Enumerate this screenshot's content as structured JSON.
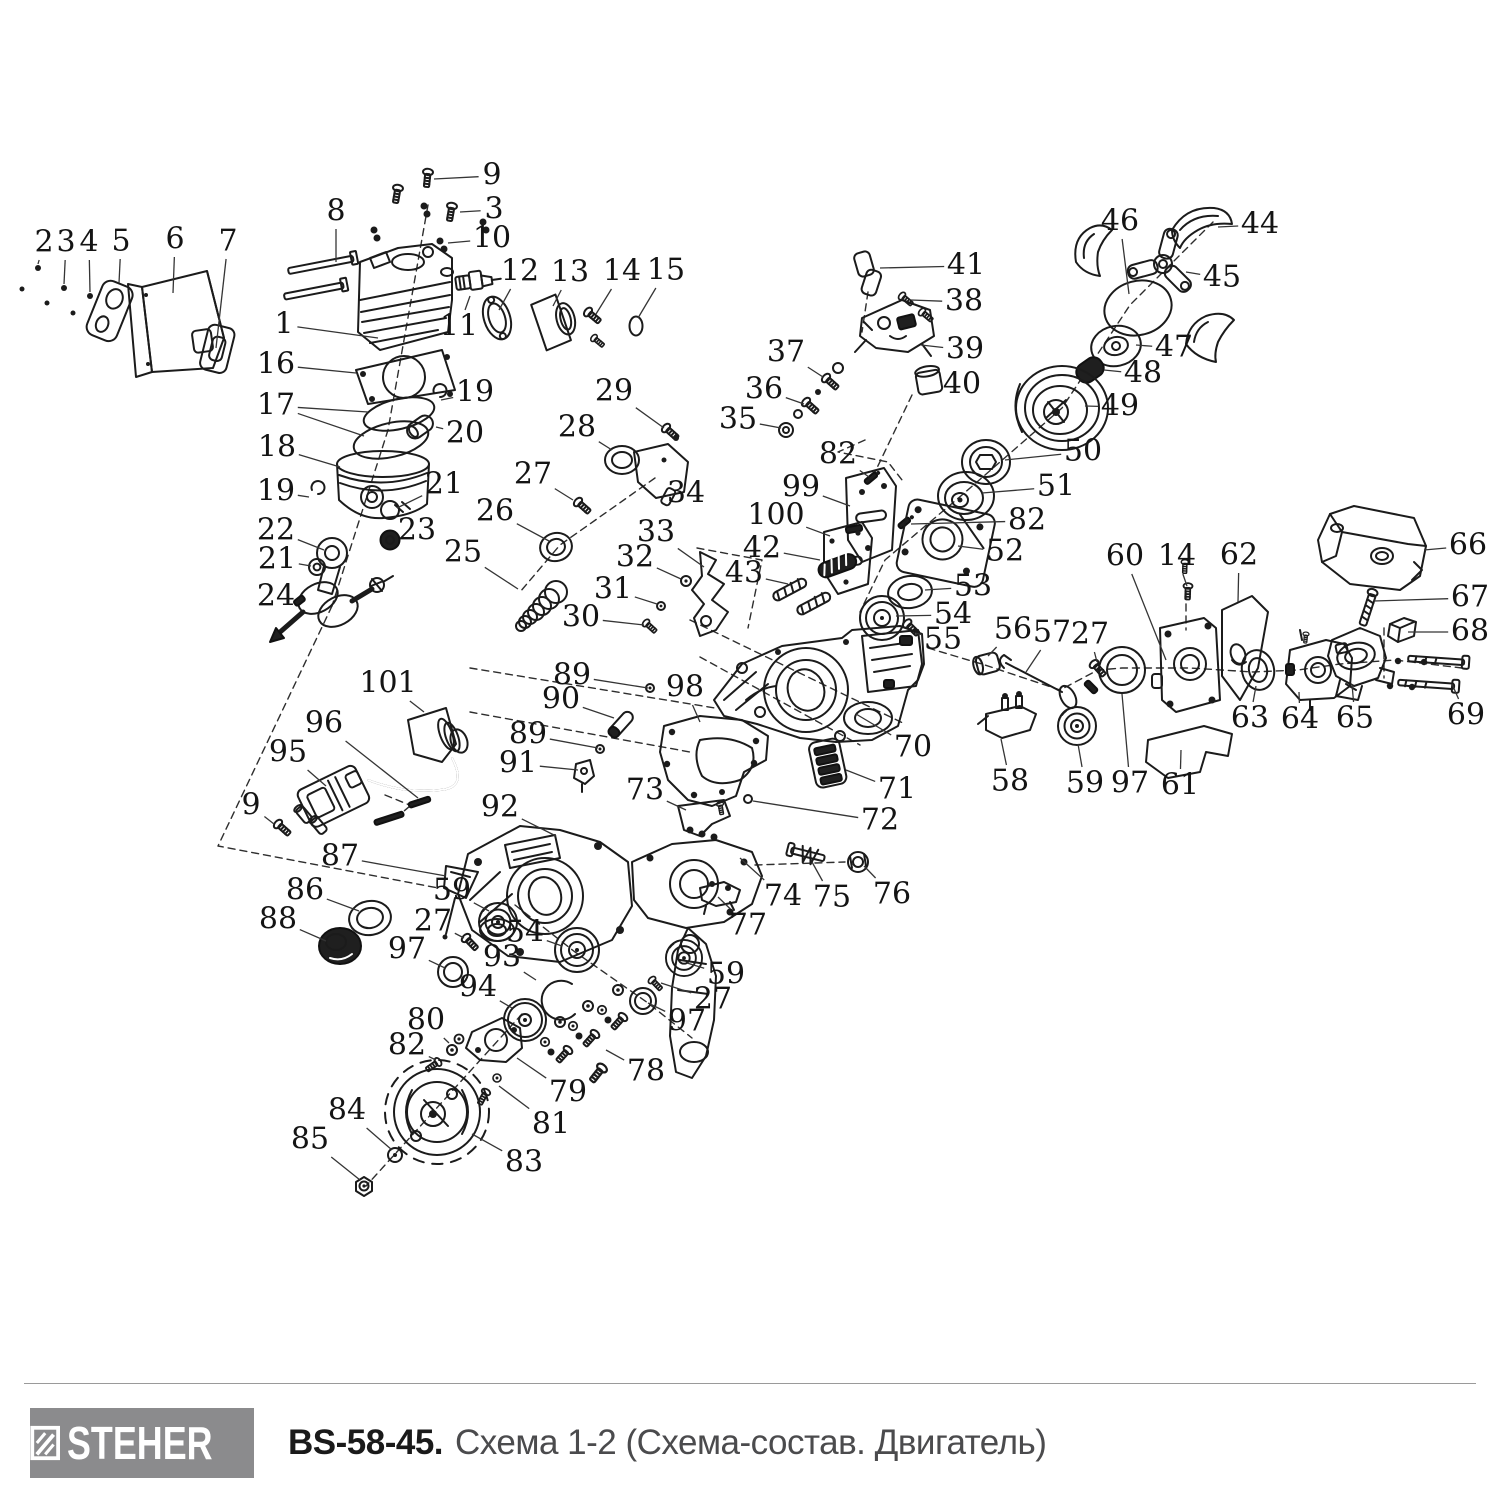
{
  "footer": {
    "brand": "STEHER",
    "model": "BS-58-45.",
    "subtitle": "Схема 1-2 (Схема-состав. Двигатель)",
    "logo_bg": "#8b8b8d",
    "logo_text_color": "#ffffff"
  },
  "diagram": {
    "description": "Exploded parts diagram of chainsaw engine, parts numbered 1-101",
    "stroke_color": "#1b1b1b",
    "leader_color": "#353535",
    "labels": [
      {
        "n": "1",
        "x": 284,
        "y": 325,
        "tx": 378,
        "ty": 338
      },
      {
        "n": "2",
        "x": 44,
        "y": 243,
        "tx": 38,
        "ty": 264
      },
      {
        "n": "3",
        "x": 66,
        "y": 243,
        "tx": 64,
        "ty": 284
      },
      {
        "n": "4",
        "x": 89,
        "y": 243,
        "tx": 90,
        "ty": 292
      },
      {
        "n": "5",
        "x": 121,
        "y": 242,
        "tx": 119,
        "ty": 283
      },
      {
        "n": "6",
        "x": 175,
        "y": 240,
        "tx": 173,
        "ty": 293
      },
      {
        "n": "7",
        "x": 228,
        "y": 242,
        "tx": 216,
        "ty": 348
      },
      {
        "n": "8",
        "x": 336,
        "y": 212,
        "tx": 336,
        "ty": 262
      },
      {
        "n": "9",
        "x": 492,
        "y": 176,
        "tx": 434,
        "ty": 179
      },
      {
        "n": "3",
        "x": 494,
        "y": 210,
        "tx": 460,
        "ty": 212
      },
      {
        "n": "10",
        "x": 492,
        "y": 239,
        "tx": 448,
        "ty": 243
      },
      {
        "n": "11",
        "x": 459,
        "y": 327,
        "tx": 470,
        "ty": 296
      },
      {
        "n": "12",
        "x": 520,
        "y": 272,
        "tx": 499,
        "ty": 310
      },
      {
        "n": "13",
        "x": 570,
        "y": 273,
        "tx": 553,
        "ty": 306
      },
      {
        "n": "14",
        "x": 622,
        "y": 272,
        "tx": 596,
        "ty": 314
      },
      {
        "n": "15",
        "x": 666,
        "y": 271,
        "tx": 638,
        "ty": 318
      },
      {
        "n": "16",
        "x": 276,
        "y": 365,
        "tx": 356,
        "ty": 373
      },
      {
        "n": "17",
        "x": 276,
        "y": 406,
        "tx": 368,
        "ty": 412,
        "tx2": 364,
        "ty2": 436
      },
      {
        "n": "18",
        "x": 277,
        "y": 448,
        "tx": 340,
        "ty": 467
      },
      {
        "n": "19",
        "x": 276,
        "y": 492,
        "tx": 309,
        "ty": 497
      },
      {
        "n": "22",
        "x": 276,
        "y": 531,
        "tx": 324,
        "ty": 550
      },
      {
        "n": "21",
        "x": 277,
        "y": 560,
        "tx": 311,
        "ty": 566
      },
      {
        "n": "24",
        "x": 276,
        "y": 597,
        "tx": 294,
        "ty": 601
      },
      {
        "n": "19",
        "x": 475,
        "y": 393,
        "tx": 441,
        "ty": 400
      },
      {
        "n": "20",
        "x": 465,
        "y": 434,
        "tx": 436,
        "ty": 427
      },
      {
        "n": "21",
        "x": 444,
        "y": 485,
        "tx": 397,
        "ty": 508
      },
      {
        "n": "23",
        "x": 417,
        "y": 531,
        "tx": 397,
        "ty": 539
      },
      {
        "n": "25",
        "x": 463,
        "y": 553,
        "tx": 518,
        "ty": 589
      },
      {
        "n": "26",
        "x": 495,
        "y": 512,
        "tx": 549,
        "ty": 541
      },
      {
        "n": "27",
        "x": 533,
        "y": 475,
        "tx": 573,
        "ty": 500
      },
      {
        "n": "28",
        "x": 577,
        "y": 428,
        "tx": 612,
        "ty": 450
      },
      {
        "n": "29",
        "x": 614,
        "y": 392,
        "tx": 664,
        "ty": 428
      },
      {
        "n": "34",
        "x": 686,
        "y": 494,
        "tx": 668,
        "ty": 480
      },
      {
        "n": "33",
        "x": 656,
        "y": 533,
        "tx": 704,
        "ty": 567
      },
      {
        "n": "32",
        "x": 635,
        "y": 558,
        "tx": 681,
        "ty": 579
      },
      {
        "n": "31",
        "x": 613,
        "y": 590,
        "tx": 657,
        "ty": 604
      },
      {
        "n": "30",
        "x": 581,
        "y": 618,
        "tx": 644,
        "ty": 625
      },
      {
        "n": "35",
        "x": 738,
        "y": 420,
        "tx": 781,
        "ty": 428
      },
      {
        "n": "36",
        "x": 764,
        "y": 390,
        "tx": 804,
        "ty": 404
      },
      {
        "n": "37",
        "x": 786,
        "y": 353,
        "tx": 823,
        "ty": 377
      },
      {
        "n": "38",
        "x": 964,
        "y": 302,
        "tx": 911,
        "ty": 300
      },
      {
        "n": "39",
        "x": 965,
        "y": 350,
        "tx": 921,
        "ty": 345
      },
      {
        "n": "40",
        "x": 962,
        "y": 385,
        "tx": 940,
        "ty": 382
      },
      {
        "n": "41",
        "x": 966,
        "y": 266,
        "tx": 880,
        "ty": 268
      },
      {
        "n": "42",
        "x": 762,
        "y": 549,
        "tx": 820,
        "ty": 560
      },
      {
        "n": "43",
        "x": 744,
        "y": 574,
        "tx": 788,
        "ty": 584
      },
      {
        "n": "82",
        "x": 838,
        "y": 455,
        "tx": 869,
        "ty": 477
      },
      {
        "n": "99",
        "x": 801,
        "y": 488,
        "tx": 850,
        "ty": 506
      },
      {
        "n": "100",
        "x": 776,
        "y": 516,
        "tx": 830,
        "ty": 536
      },
      {
        "n": "44",
        "x": 1260,
        "y": 225,
        "tx": 1218,
        "ty": 227
      },
      {
        "n": "45",
        "x": 1222,
        "y": 278,
        "tx": 1186,
        "ty": 272
      },
      {
        "n": "46",
        "x": 1120,
        "y": 222,
        "tx": 1129,
        "ty": 294
      },
      {
        "n": "47",
        "x": 1174,
        "y": 348,
        "tx": 1136,
        "ty": 345
      },
      {
        "n": "48",
        "x": 1143,
        "y": 374,
        "tx": 1104,
        "ty": 370
      },
      {
        "n": "49",
        "x": 1120,
        "y": 407,
        "tx": 1085,
        "ty": 406
      },
      {
        "n": "50",
        "x": 1083,
        "y": 452,
        "tx": 1005,
        "ty": 460
      },
      {
        "n": "51",
        "x": 1056,
        "y": 487,
        "tx": 982,
        "ty": 493
      },
      {
        "n": "82",
        "x": 1027,
        "y": 521,
        "tx": 911,
        "ty": 524
      },
      {
        "n": "52",
        "x": 1005,
        "y": 552,
        "tx": 958,
        "ty": 546
      },
      {
        "n": "53",
        "x": 973,
        "y": 587,
        "tx": 925,
        "ty": 590
      },
      {
        "n": "54",
        "x": 953,
        "y": 615,
        "tx": 896,
        "ty": 616
      },
      {
        "n": "55",
        "x": 943,
        "y": 640,
        "tx": 915,
        "ty": 633
      },
      {
        "n": "56",
        "x": 1013,
        "y": 630,
        "tx": 988,
        "ty": 656
      },
      {
        "n": "57",
        "x": 1052,
        "y": 633,
        "tx": 1026,
        "ty": 672
      },
      {
        "n": "27",
        "x": 1090,
        "y": 635,
        "tx": 1097,
        "ty": 662
      },
      {
        "n": "58",
        "x": 1010,
        "y": 782,
        "tx": 1001,
        "ty": 739
      },
      {
        "n": "59",
        "x": 1085,
        "y": 784,
        "tx": 1078,
        "ty": 744
      },
      {
        "n": "97",
        "x": 1130,
        "y": 784,
        "tx": 1122,
        "ty": 694
      },
      {
        "n": "61",
        "x": 1180,
        "y": 786,
        "tx": 1181,
        "ty": 750
      },
      {
        "n": "60",
        "x": 1125,
        "y": 557,
        "tx": 1166,
        "ty": 660
      },
      {
        "n": "14",
        "x": 1177,
        "y": 557,
        "tx": 1187,
        "ty": 586
      },
      {
        "n": "62",
        "x": 1239,
        "y": 556,
        "tx": 1238,
        "ty": 602
      },
      {
        "n": "63",
        "x": 1250,
        "y": 719,
        "tx": 1256,
        "ty": 686
      },
      {
        "n": "64",
        "x": 1300,
        "y": 720,
        "tx": 1299,
        "ty": 692
      },
      {
        "n": "65",
        "x": 1355,
        "y": 719,
        "tx": 1352,
        "ty": 684
      },
      {
        "n": "66",
        "x": 1468,
        "y": 546,
        "tx": 1424,
        "ty": 550
      },
      {
        "n": "67",
        "x": 1470,
        "y": 598,
        "tx": 1374,
        "ty": 601
      },
      {
        "n": "68",
        "x": 1470,
        "y": 632,
        "tx": 1408,
        "ty": 632
      },
      {
        "n": "69",
        "x": 1466,
        "y": 716,
        "tx": 1452,
        "ty": 684
      },
      {
        "n": "70",
        "x": 913,
        "y": 748,
        "tx": 856,
        "ty": 714
      },
      {
        "n": "71",
        "x": 897,
        "y": 790,
        "tx": 846,
        "ty": 770
      },
      {
        "n": "72",
        "x": 880,
        "y": 821,
        "tx": 753,
        "ty": 801
      },
      {
        "n": "73",
        "x": 645,
        "y": 791,
        "tx": 686,
        "ty": 810
      },
      {
        "n": "74",
        "x": 783,
        "y": 897,
        "tx": 740,
        "ty": 858
      },
      {
        "n": "75",
        "x": 832,
        "y": 898,
        "tx": 812,
        "ty": 862
      },
      {
        "n": "76",
        "x": 892,
        "y": 895,
        "tx": 864,
        "ty": 866
      },
      {
        "n": "77",
        "x": 748,
        "y": 926,
        "tx": 718,
        "ty": 897
      },
      {
        "n": "89",
        "x": 572,
        "y": 676,
        "tx": 648,
        "ty": 688
      },
      {
        "n": "90",
        "x": 561,
        "y": 700,
        "tx": 614,
        "ty": 718
      },
      {
        "n": "89",
        "x": 528,
        "y": 735,
        "tx": 598,
        "ty": 748
      },
      {
        "n": "91",
        "x": 518,
        "y": 764,
        "tx": 578,
        "ty": 770
      },
      {
        "n": "98",
        "x": 685,
        "y": 688,
        "tx": 700,
        "ty": 722
      },
      {
        "n": "92",
        "x": 500,
        "y": 808,
        "tx": 556,
        "ty": 836
      },
      {
        "n": "101",
        "x": 388,
        "y": 684,
        "tx": 424,
        "ty": 712
      },
      {
        "n": "96",
        "x": 324,
        "y": 724,
        "tx": 418,
        "ty": 798
      },
      {
        "n": "95",
        "x": 288,
        "y": 753,
        "tx": 326,
        "ty": 786
      },
      {
        "n": "9",
        "x": 251,
        "y": 806,
        "tx": 274,
        "ty": 824
      },
      {
        "n": "87",
        "x": 340,
        "y": 857,
        "tx": 446,
        "ty": 876
      },
      {
        "n": "86",
        "x": 305,
        "y": 891,
        "tx": 359,
        "ty": 911
      },
      {
        "n": "88",
        "x": 278,
        "y": 920,
        "tx": 326,
        "ty": 941
      },
      {
        "n": "59",
        "x": 452,
        "y": 891,
        "tx": 489,
        "ty": 911
      },
      {
        "n": "27",
        "x": 433,
        "y": 922,
        "tx": 464,
        "ty": 938
      },
      {
        "n": "97",
        "x": 407,
        "y": 950,
        "tx": 445,
        "ty": 968
      },
      {
        "n": "54",
        "x": 525,
        "y": 933,
        "tx": 562,
        "ty": 946
      },
      {
        "n": "93",
        "x": 502,
        "y": 958,
        "tx": 536,
        "ty": 980
      },
      {
        "n": "94",
        "x": 478,
        "y": 988,
        "tx": 512,
        "ty": 1008
      },
      {
        "n": "80",
        "x": 426,
        "y": 1021,
        "tx": 449,
        "ty": 1043
      },
      {
        "n": "82",
        "x": 407,
        "y": 1046,
        "tx": 436,
        "ty": 1060
      },
      {
        "n": "79",
        "x": 568,
        "y": 1093,
        "tx": 517,
        "ty": 1058
      },
      {
        "n": "81",
        "x": 551,
        "y": 1125,
        "tx": 499,
        "ty": 1086
      },
      {
        "n": "83",
        "x": 524,
        "y": 1163,
        "tx": 472,
        "ty": 1134
      },
      {
        "n": "84",
        "x": 347,
        "y": 1111,
        "tx": 392,
        "ty": 1150
      },
      {
        "n": "85",
        "x": 310,
        "y": 1140,
        "tx": 360,
        "ty": 1180
      },
      {
        "n": "78",
        "x": 646,
        "y": 1072,
        "tx": 606,
        "ty": 1050
      },
      {
        "n": "97",
        "x": 687,
        "y": 1022,
        "tx": 648,
        "ty": 1003
      },
      {
        "n": "27",
        "x": 713,
        "y": 1000,
        "tx": 661,
        "ty": 983
      },
      {
        "n": "59",
        "x": 726,
        "y": 975,
        "tx": 687,
        "ty": 963
      }
    ]
  }
}
